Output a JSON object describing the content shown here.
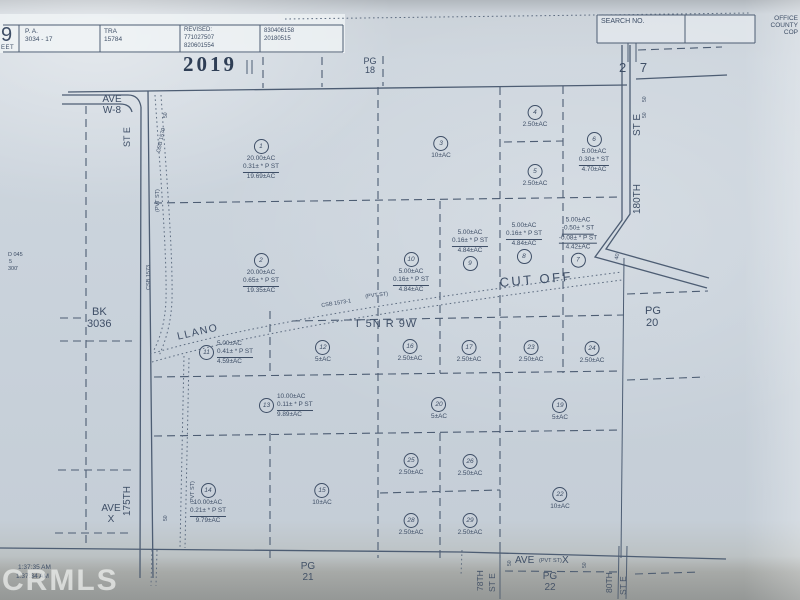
{
  "header": {
    "sheet_big": "9",
    "sheet_small": "EET",
    "pa_label": "P. A.",
    "pa_value": "3034 - 17",
    "tra_label": "TRA",
    "tra_value": "15784",
    "revised_label": "REVISED:",
    "revised_1": "771027507",
    "revised_2": "820601554",
    "stamp_1": "830406158",
    "stamp_2": "20180515",
    "search_label": "SEARCH NO.",
    "office_1": "OFFICE",
    "office_2": "COUNTY",
    "office_3": "COP"
  },
  "margins": {
    "year": "2019",
    "pg_top_1": "PG",
    "pg_top_2": "18",
    "sec_right": "2 7",
    "bk_1": "BK",
    "bk_2": "3036",
    "pg_right_1": "PG",
    "pg_right_2": "20",
    "pg_bottom_1": "PG",
    "pg_bottom_2": "21",
    "pg_bottom_right_1": "PG",
    "pg_bottom_right_2": "22",
    "note_1": "D 045",
    "note_2": "5",
    "note_3": "300'"
  },
  "roads": {
    "ave_w8_1": "AVE",
    "ave_w8_2": "W-8",
    "st_e_left": "ST E",
    "st_175th": "175TH",
    "pvt_st_upper": "(PVT ST)",
    "pvt_st_lower": "(PVT ST)",
    "pvt_st_diag": "(PVT ST)",
    "csb_1579": "CSB 1579",
    "csb_1573": "CSB 1573",
    "csb_1573_1": "CSB 1573-1",
    "llano": "LLANO",
    "cut_off": "CUT OFF",
    "township": "T 5N R 9W",
    "st_e_right": "ST E",
    "st_180th": "180TH",
    "ave_x_1": "AVE",
    "ave_x_2": "X",
    "ave_bottom": "AVE",
    "ave_bottom_pvt": "(PVT ST)",
    "ave_bottom_x": "X",
    "st_78th": "78TH",
    "st_78th_e": "ST E",
    "st_80th": "80TH",
    "st_80th_e": "ST E",
    "dim50_ave_w8": "50",
    "dim50_ave_x": "50",
    "dim50_r1": "50",
    "dim50_r2": "50",
    "dim50_b1": "50",
    "dim50_b2": "50",
    "dim40": "40"
  },
  "parcels": [
    {
      "n": "1",
      "x": 261,
      "y": 146,
      "mode": "below",
      "lines": [
        "20.00±AC",
        "0.31± * P ST",
        "19.69±AC"
      ],
      "u": [
        1
      ]
    },
    {
      "n": "2",
      "x": 261,
      "y": 260,
      "mode": "below",
      "lines": [
        "20.00±AC",
        "0.65± * P ST",
        "19.35±AC"
      ],
      "u": [
        1
      ]
    },
    {
      "n": "3",
      "x": 441,
      "y": 143,
      "mode": "below",
      "lines": [
        "10±AC"
      ],
      "u": []
    },
    {
      "n": "4",
      "x": 535,
      "y": 112,
      "mode": "below",
      "lines": [
        "2.50±AC"
      ],
      "u": []
    },
    {
      "n": "5",
      "x": 535,
      "y": 171,
      "mode": "below",
      "lines": [
        "2.50±AC"
      ],
      "u": []
    },
    {
      "n": "6",
      "x": 594,
      "y": 139,
      "mode": "below",
      "lines": [
        "5.00±AC",
        "0.30± * ST",
        "4.70±AC"
      ],
      "u": [
        1
      ]
    },
    {
      "n": "7",
      "x": 578,
      "y": 261,
      "mode": "above",
      "lines": [
        "5.00±AC",
        "-0.50± * ST",
        "-0.08± * P ST",
        "4.42±AC"
      ],
      "u": [
        1,
        2
      ]
    },
    {
      "n": "8",
      "x": 524,
      "y": 257,
      "mode": "above",
      "lines": [
        "5.00±AC",
        "0.16± * P ST",
        "4.84±AC"
      ],
      "u": [
        1
      ]
    },
    {
      "n": "9",
      "x": 470,
      "y": 264,
      "mode": "above",
      "lines": [
        "5.00±AC",
        "0.16± * P ST",
        "4.84±AC"
      ],
      "u": [
        1
      ]
    },
    {
      "n": "10",
      "x": 411,
      "y": 259,
      "mode": "below",
      "lines": [
        "5.00±AC",
        "0.16± * P ST",
        "4.84±AC"
      ],
      "u": [
        1
      ]
    },
    {
      "n": "11",
      "x": 206,
      "y": 353,
      "mode": "right",
      "lines": [
        "5.00±AC",
        "0.41± * P ST",
        "4.59±AC"
      ],
      "u": [
        1
      ]
    },
    {
      "n": "12",
      "x": 323,
      "y": 347,
      "mode": "below",
      "lines": [
        "5±AC"
      ],
      "u": []
    },
    {
      "n": "13",
      "x": 266,
      "y": 406,
      "mode": "right",
      "lines": [
        "10.00±AC",
        "0.11± * P ST",
        "9.89±AC"
      ],
      "u": [
        1
      ]
    },
    {
      "n": "14",
      "x": 208,
      "y": 490,
      "mode": "below",
      "lines": [
        "10.00±AC",
        "0.21± * P ST",
        "9.79±AC"
      ],
      "u": [
        1
      ]
    },
    {
      "n": "15",
      "x": 322,
      "y": 490,
      "mode": "below",
      "lines": [
        "10±AC"
      ],
      "u": []
    },
    {
      "n": "16",
      "x": 410,
      "y": 346,
      "mode": "below",
      "lines": [
        "2.50±AC"
      ],
      "u": []
    },
    {
      "n": "17",
      "x": 469,
      "y": 347,
      "mode": "below",
      "lines": [
        "2.50±AC"
      ],
      "u": []
    },
    {
      "n": "19",
      "x": 560,
      "y": 405,
      "mode": "below",
      "lines": [
        "5±AC"
      ],
      "u": []
    },
    {
      "n": "20",
      "x": 439,
      "y": 404,
      "mode": "below",
      "lines": [
        "5±AC"
      ],
      "u": []
    },
    {
      "n": "22",
      "x": 560,
      "y": 494,
      "mode": "below",
      "lines": [
        "10±AC"
      ],
      "u": []
    },
    {
      "n": "23",
      "x": 531,
      "y": 347,
      "mode": "below",
      "lines": [
        "2.50±AC"
      ],
      "u": []
    },
    {
      "n": "24",
      "x": 592,
      "y": 348,
      "mode": "below",
      "lines": [
        "2.50±AC"
      ],
      "u": []
    },
    {
      "n": "25",
      "x": 411,
      "y": 460,
      "mode": "below",
      "lines": [
        "2.50±AC"
      ],
      "u": []
    },
    {
      "n": "26",
      "x": 470,
      "y": 461,
      "mode": "below",
      "lines": [
        "2.50±AC"
      ],
      "u": []
    },
    {
      "n": "28",
      "x": 411,
      "y": 520,
      "mode": "below",
      "lines": [
        "2.50±AC"
      ],
      "u": []
    },
    {
      "n": "29",
      "x": 470,
      "y": 520,
      "mode": "below",
      "lines": [
        "2.50±AC"
      ],
      "u": []
    }
  ],
  "footer": {
    "time_1": "1:37:35 AM",
    "time_2": "1:37:34 AM",
    "watermark": "CRMLS"
  },
  "colors": {
    "ink": "#3e4e66",
    "paper": "#ccd3da",
    "bottom_band": "#a7aaa8",
    "watermark": "rgba(252,253,252,0.62)"
  }
}
